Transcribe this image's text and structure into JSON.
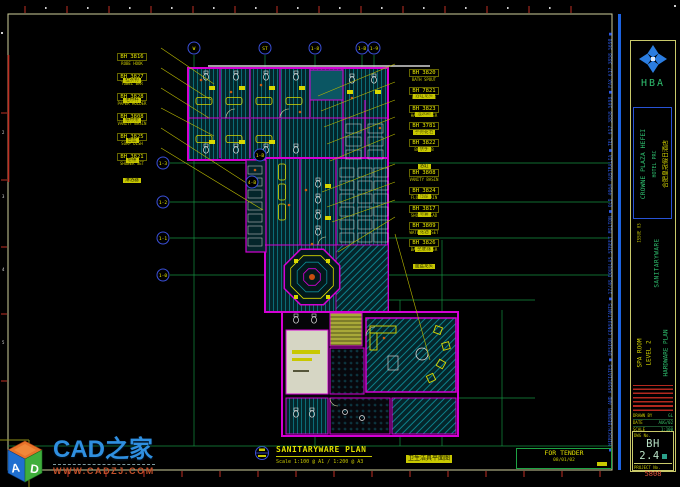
{
  "sheet": {
    "bg": "#000000"
  },
  "wm": {
    "cube_a": "A",
    "cube_d": "D",
    "name": "CAD之家",
    "url": "WWW.CADZJ.COM"
  },
  "tb": {
    "address": "■ HIRSCH/BEDNER AND ASSOCIATES ■ DESIGN CONSULTANTS ■ 17/48 DOUGLAS STREET MILTON ■ QLD 4064 AUSTRALIA ■ TEL 617 3858 5698 ■ FAX 617 3858 5698 ■",
    "logo_text": "HBA",
    "project": "CROWNE PLAZA HEFEI",
    "project_sub": "HOTEL PRC",
    "project_cn": "合肥皇冠假日酒店",
    "issue": "ISSUE 03",
    "category": "SANITARYWARE",
    "room": "SPA ROOM",
    "level": "LEVEL 2",
    "sheet_title": "HARDWARE PLAN",
    "fields": [
      {
        "label": "DRAWN BY",
        "value": "GL"
      },
      {
        "label": "DATE",
        "value": "AUG/02"
      },
      {
        "label": "SCALE",
        "value": "1:100"
      }
    ],
    "dwg_label": "DWG No.",
    "dwg_no": "BH 2.4",
    "projno_label": "PROJECT No.",
    "projno": "5808"
  },
  "footer": {
    "title": "SANITARYWARE PLAN",
    "scale": "Scale 1:100 @ A1 / 1:200 @ A3",
    "cn": "卫生洁具平面图",
    "tender_label": "FOR TENDER",
    "tender_date": "08/01/02"
  },
  "plan": {
    "bubbles": [
      {
        "label": "W",
        "x": 194,
        "y": 48
      },
      {
        "label": "ST",
        "x": 265,
        "y": 48
      },
      {
        "label": "1-8",
        "x": 315,
        "y": 48
      },
      {
        "label": "1-B",
        "x": 362,
        "y": 48
      },
      {
        "label": "1-9",
        "x": 374,
        "y": 48
      },
      {
        "label": "1-3",
        "x": 163,
        "y": 163
      },
      {
        "label": "1-2",
        "x": 163,
        "y": 202
      },
      {
        "label": "1-1",
        "x": 163,
        "y": 238
      },
      {
        "label": "1-0",
        "x": 163,
        "y": 275
      },
      {
        "label": "1-B",
        "x": 260,
        "y": 155
      },
      {
        "label": "4-B",
        "x": 252,
        "y": 182
      }
    ],
    "grid": {
      "v": [
        {
          "x": 194,
          "y1": 55,
          "y2": 446
        },
        {
          "x": 265,
          "y1": 55,
          "y2": 160
        },
        {
          "x": 315,
          "y1": 55,
          "y2": 446
        },
        {
          "x": 362,
          "y1": 55,
          "y2": 312
        },
        {
          "x": 374,
          "y1": 55,
          "y2": 200
        },
        {
          "x": 400,
          "y1": 300,
          "y2": 446
        },
        {
          "x": 442,
          "y1": 240,
          "y2": 446
        },
        {
          "x": 502,
          "y1": 310,
          "y2": 446
        }
      ],
      "h": [
        {
          "y": 163,
          "x1": 170,
          "x2": 610
        },
        {
          "y": 202,
          "x1": 170,
          "x2": 610
        },
        {
          "y": 238,
          "x1": 170,
          "x2": 610
        },
        {
          "y": 275,
          "x1": 170,
          "x2": 610
        },
        {
          "y": 300,
          "x1": 355,
          "x2": 535
        },
        {
          "y": 398,
          "x1": 313,
          "x2": 535
        },
        {
          "y": 446,
          "x1": 8,
          "x2": 612
        }
      ]
    },
    "callouts_left": [
      {
        "code": "BH 3816",
        "desc": "ROBE HOOK",
        "cn": "挂衣钩",
        "x": 104,
        "y": 44,
        "tx": 214,
        "ty": 84
      },
      {
        "code": "BH 3827",
        "desc": "TOWEL BAR",
        "cn": "毛巾杆",
        "x": 104,
        "y": 64,
        "tx": 211,
        "ty": 100
      },
      {
        "code": "BH 3828",
        "desc": "PAPER HOLDER",
        "cn": "纸巾架",
        "x": 104,
        "y": 84,
        "tx": 209,
        "ty": 118
      },
      {
        "code": "BH 3808",
        "desc": "VANITY BASIN",
        "cn": "台盆",
        "x": 104,
        "y": 104,
        "tx": 214,
        "ty": 136
      },
      {
        "code": "BH 3825",
        "desc": "SOAP DISH",
        "cn": "皂碟",
        "x": 104,
        "y": 124,
        "tx": 248,
        "ty": 184
      },
      {
        "code": "BH 3821",
        "desc": "SHOWER SET",
        "cn": "淋浴器",
        "x": 104,
        "y": 144,
        "tx": 263,
        "ty": 210
      }
    ],
    "callouts_right": [
      {
        "code": "BH 3820",
        "desc": "BATH SPOUT",
        "cn": "浴缸龙头",
        "x": 396,
        "y": 60,
        "tx": 318,
        "ty": 96
      },
      {
        "code": "BH 7821",
        "desc": "BATH MIXER",
        "cn": "混水阀",
        "x": 396,
        "y": 78,
        "tx": 321,
        "ty": 111
      },
      {
        "code": "BH 3823",
        "desc": "HAND SHOWER",
        "cn": "手持花洒",
        "x": 396,
        "y": 96,
        "tx": 324,
        "ty": 127
      },
      {
        "code": "BH 3781",
        "desc": "GRAB BAR",
        "cn": "扶手",
        "x": 396,
        "y": 113,
        "tx": 327,
        "ty": 144
      },
      {
        "code": "BH 3822",
        "desc": "BATH TUB",
        "cn": "浴缸",
        "x": 396,
        "y": 130,
        "tx": 330,
        "ty": 161
      },
      {
        "code": "BH 3808",
        "desc": "VANITY BASIN",
        "cn": "台盆",
        "x": 396,
        "y": 160,
        "tx": 322,
        "ty": 192
      },
      {
        "code": "BH 3824",
        "desc": "FLOOR DRAIN",
        "cn": "地漏",
        "x": 396,
        "y": 178,
        "tx": 327,
        "ty": 207
      },
      {
        "code": "BH 3817",
        "desc": "SHOWER HEAD",
        "cn": "花洒",
        "x": 396,
        "y": 196,
        "tx": 332,
        "ty": 222
      },
      {
        "code": "BH 3809",
        "desc": "WATER CLOSET",
        "cn": "坐便器",
        "x": 396,
        "y": 213,
        "tx": 338,
        "ty": 252
      },
      {
        "code": "BH 3826",
        "desc": "BASIN MIXER",
        "cn": "面盆龙头",
        "x": 396,
        "y": 230,
        "tx": 430,
        "ty": 360
      }
    ]
  },
  "frame": {
    "top_ticks": {
      "from": 25,
      "step": 42,
      "count": 14
    },
    "bottom_ticks": {
      "from": 30,
      "step": 38,
      "count": 16
    },
    "left_ticks": {
      "from": 113,
      "step": 67,
      "count": 5
    },
    "left_numbers": [
      {
        "t": "2",
        "y": 133
      },
      {
        "t": "3",
        "y": 197
      },
      {
        "t": "4",
        "y": 270
      },
      {
        "t": "5",
        "y": 343
      }
    ]
  }
}
